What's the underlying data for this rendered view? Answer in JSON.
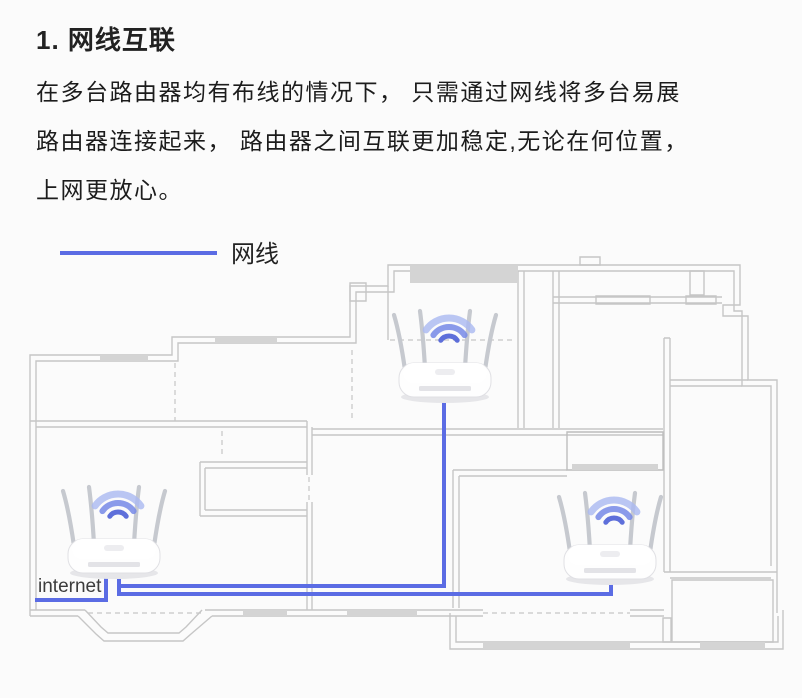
{
  "header": {
    "title": "1. 网线互联"
  },
  "paragraph": {
    "lines": [
      "在多台路由器均有布线的情况下， 只需通过网线将多台易展",
      "路由器连接起来， 路由器之间互联更加稳定,无论在何位置，",
      "上网更放心。"
    ]
  },
  "legend": {
    "label": "网线"
  },
  "diagram": {
    "internet_label": "internet",
    "cable_color": "#5b6ce4",
    "wall_color": "#c6c6c6",
    "wall_dark_color": "#bdbdbd",
    "window_fill": "#d4d4d4",
    "wifi_arc_colors": [
      "#aab9f1",
      "#7688e6",
      "#4c5fd6"
    ],
    "router_body_color": "#fefefe",
    "router_antenna_color": "#c6c9cf",
    "routers": [
      {
        "name": "top-router"
      },
      {
        "name": "internet-router"
      },
      {
        "name": "bottom-right-router"
      }
    ]
  }
}
